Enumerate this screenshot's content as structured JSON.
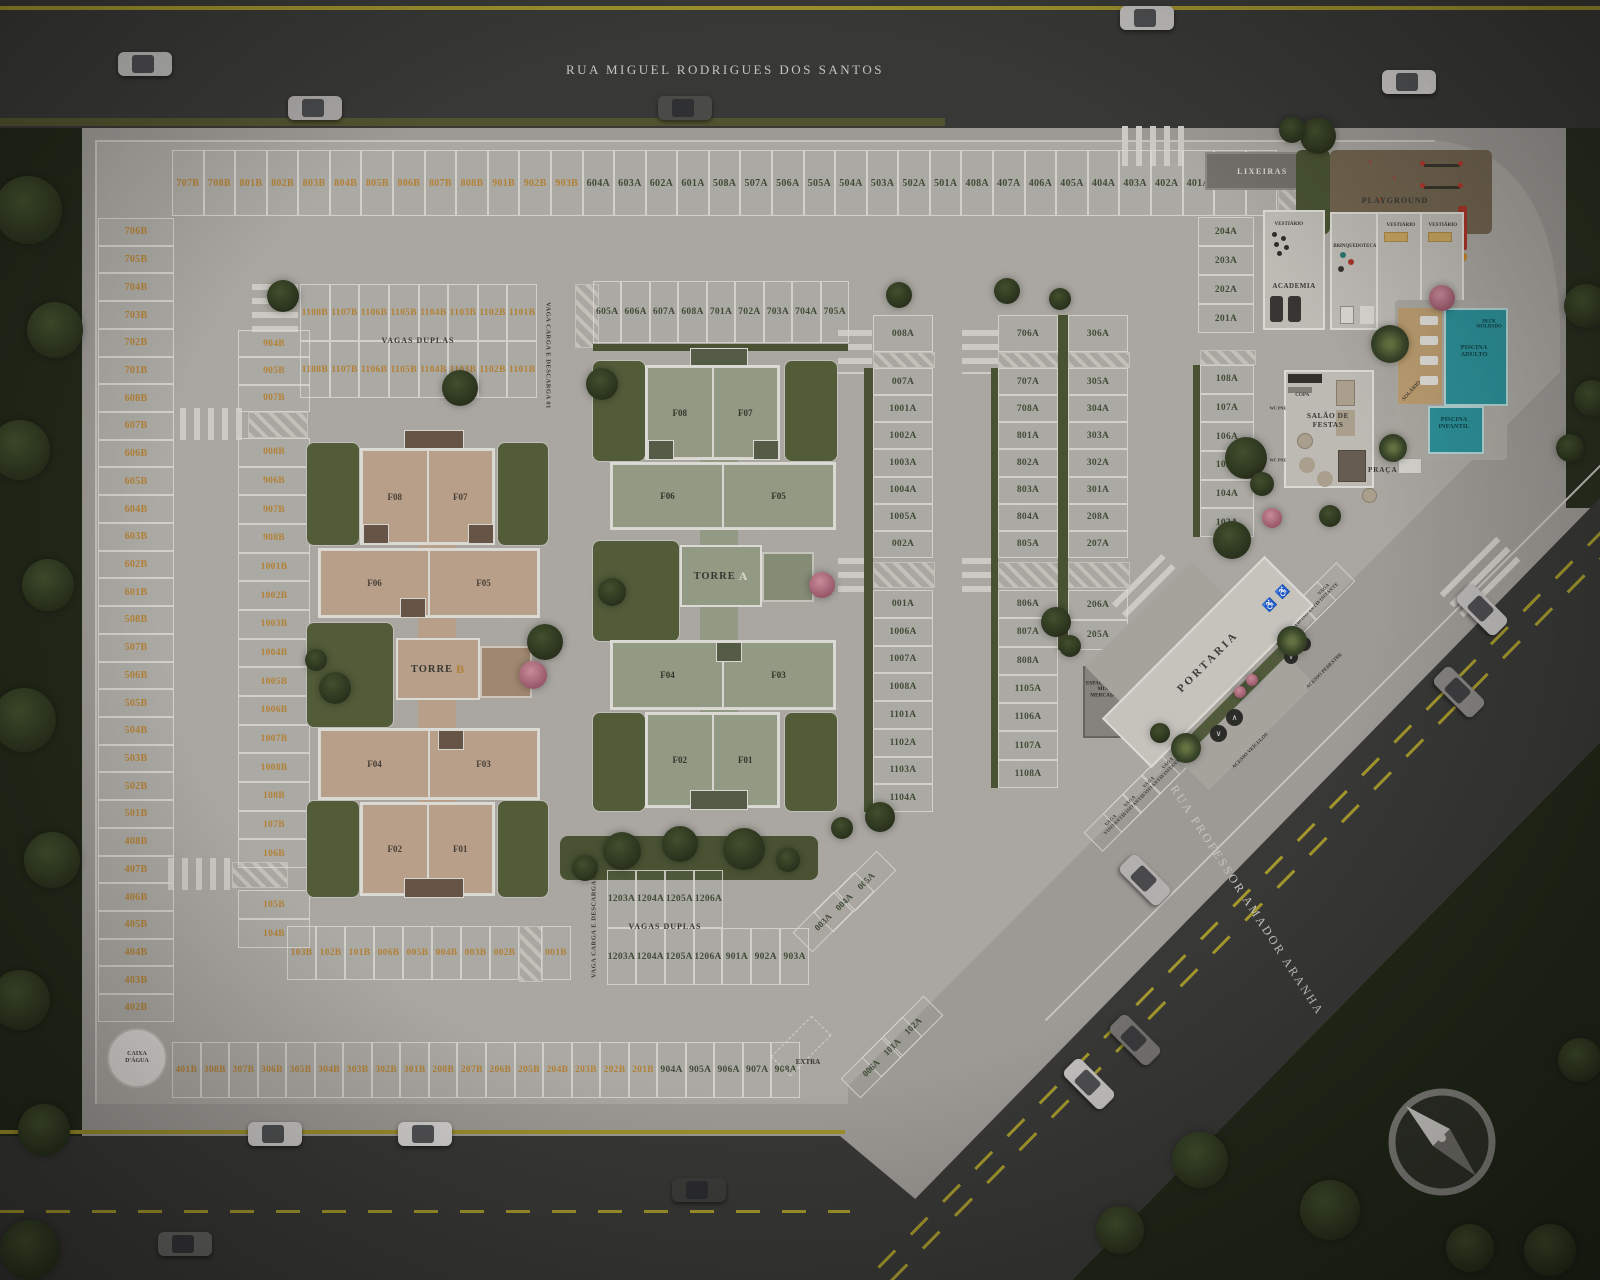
{
  "streets": {
    "top": "RUA MIGUEL RODRIGUES DOS SANTOS",
    "right": "RUA PROFESSOR AMADOR ARANHA"
  },
  "towers": {
    "b": {
      "name": "TORRE",
      "letter": "B",
      "units": [
        "F08",
        "F07",
        "F06",
        "F05",
        "F04",
        "F03",
        "F02",
        "F01"
      ]
    },
    "a": {
      "name": "TORRE",
      "letter": "A",
      "units": [
        "F08",
        "F07",
        "F06",
        "F05",
        "F04",
        "F03",
        "F02",
        "F01"
      ]
    }
  },
  "amenities": {
    "lixeiras": "LIXEIRAS",
    "playground": "PLAYGROUND",
    "academia": "ACADEMIA",
    "brinquedoteca": "BRINQUEDOTECA",
    "vestiario": "VESTIÁRIO",
    "salao_de_festas": "SALÃO DE FESTAS",
    "copa": "COPA",
    "wc_pne": "WC PNE",
    "praca": "PRAÇA",
    "solario": "SOLÁRIO",
    "deck_molhado": "DECK MOLHADO",
    "piscina_adulto": "PISCINA ADULTO",
    "piscina_infantil": "PISCINA INFANTIL",
    "mini_mercado": "ESPAÇO PARA MINI MERCADO",
    "portaria": "PORTARIA",
    "acesso_veiculos": "ACESSO VEÍCULOS",
    "acesso_pedestre": "ACESSO PEDESTRE",
    "caixa_dagua": "CAIXA D'ÁGUA",
    "extra": "EXTRA"
  },
  "parking": {
    "vagas_duplas": "VAGAS DUPLAS",
    "carga_descarga_01": "VAGA CARGA E DESCARGA 01",
    "carga_descarga_02": "VAGA CARGA E DESCARGA 02",
    "visitante": "VAGA VISITANTE",
    "top_row": [
      "707B",
      "708B",
      "801B",
      "802B",
      "803B",
      "804B",
      "805B",
      "806B",
      "807B",
      "808B",
      "901B",
      "902B",
      "903B",
      "604A",
      "603A",
      "602A",
      "601A",
      "508A",
      "507A",
      "506A",
      "505A",
      "504A",
      "503A",
      "502A",
      "501A",
      "408A",
      "407A",
      "406A",
      "405A",
      "404A",
      "403A",
      "402A",
      "401A",
      "308A",
      "307A"
    ],
    "left_col": [
      "706B",
      "705B",
      "704B",
      "703B",
      "702B",
      "701B",
      "608B",
      "607B",
      "606B",
      "605B",
      "604B",
      "603B",
      "602B",
      "601B",
      "508B",
      "507B",
      "506B",
      "505B",
      "504B",
      "503B",
      "502B",
      "501B",
      "408B",
      "407B",
      "406B",
      "405B",
      "404B",
      "403B",
      "402B"
    ],
    "inner_col_top": [
      "904B",
      "905B",
      "007B"
    ],
    "inner_col_mid": [
      "008B",
      "906B",
      "907B",
      "908B",
      "1001B",
      "1002B",
      "1003B",
      "1004B",
      "1005B",
      "1006B",
      "1007B",
      "1008B",
      "108B",
      "107B",
      "106B"
    ],
    "inner_col_bottom": [
      "105B",
      "104B"
    ],
    "duplas1_row1": [
      "1108B",
      "1107B",
      "1106B",
      "1105B",
      "1104B",
      "1103B",
      "1102B",
      "1101B"
    ],
    "duplas1_row2": [
      "1108B",
      "1107B",
      "1106B",
      "1105B",
      "1104B",
      "1103B",
      "1102B",
      "1101B"
    ],
    "row_a_upper": [
      "605A",
      "606A",
      "607A",
      "608A",
      "701A",
      "702A",
      "703A",
      "704A",
      "705A"
    ],
    "col_a1_top": [
      "008A"
    ],
    "col_a1_mid": [
      "007A",
      "1001A",
      "1002A",
      "1003A",
      "1004A",
      "1005A",
      "002A"
    ],
    "col_a1_bottom": [
      "001A",
      "1006A",
      "1007A",
      "1008A",
      "1101A",
      "1102A",
      "1103A",
      "1104A"
    ],
    "col_a2_top": [
      "706A"
    ],
    "col_a2_mid": [
      "707A",
      "708A",
      "801A",
      "802A",
      "803A",
      "804A",
      "805A"
    ],
    "col_a2_bottom": [
      "806A",
      "807A",
      "808A",
      "1105A",
      "1106A",
      "1107A",
      "1108A"
    ],
    "col_a3_top": [
      "306A"
    ],
    "col_a3_mid": [
      "305A",
      "304A",
      "303A",
      "302A",
      "301A",
      "208A",
      "207A"
    ],
    "col_a3_bottom": [
      "206A",
      "205A"
    ],
    "col_right_upper": [
      "204A",
      "203A",
      "202A",
      "201A"
    ],
    "col_right_lower": [
      "108A",
      "107A",
      "106A",
      "105A",
      "104A",
      "103A"
    ],
    "duplas2_row1": [
      "1203A",
      "1204A",
      "1205A",
      "1206A"
    ],
    "duplas2_row2": [
      "1203A",
      "1204A",
      "1205A",
      "1206A",
      "901A",
      "902A",
      "903A"
    ],
    "diag_mid": [
      "005A",
      "004A",
      "003A"
    ],
    "diag_low": [
      "102A",
      "101A",
      "006A"
    ],
    "row_b_bottom": [
      "103B",
      "102B",
      "101B",
      "006B",
      "005B",
      "004B",
      "003B",
      "002B"
    ],
    "row_b_bottom_extra": [
      "001B"
    ],
    "bottom_row": [
      "401B",
      "308B",
      "307B",
      "306B",
      "305B",
      "304B",
      "303B",
      "302B",
      "301B",
      "208B",
      "207B",
      "206B",
      "205B",
      "204B",
      "203B",
      "202B",
      "201B",
      "904A",
      "905A",
      "906A",
      "907A",
      "908A"
    ],
    "visitor_upper": [
      "VAGA VISITANTE",
      "VAGA VISITANTE",
      "VAGA VISITANTE",
      "VAGA VISITANTE"
    ],
    "visitor_lower": [
      "VAGA VISITANTE",
      "VAGA VISITANTE",
      "VAGA VISITANTE",
      "VAGA VISITANTE"
    ]
  },
  "colors": {
    "stall_a_text": "#44513a",
    "stall_b_text": "#bf8a3a",
    "asphalt": "#3b3b39",
    "concrete": "#b6b3ad",
    "lawn": "#57623c",
    "pool": "#2e9aa3",
    "torre_a_fill": "#9ca58e",
    "torre_b_fill": "#c6ab94",
    "yellow_line": "#b0a32f"
  }
}
